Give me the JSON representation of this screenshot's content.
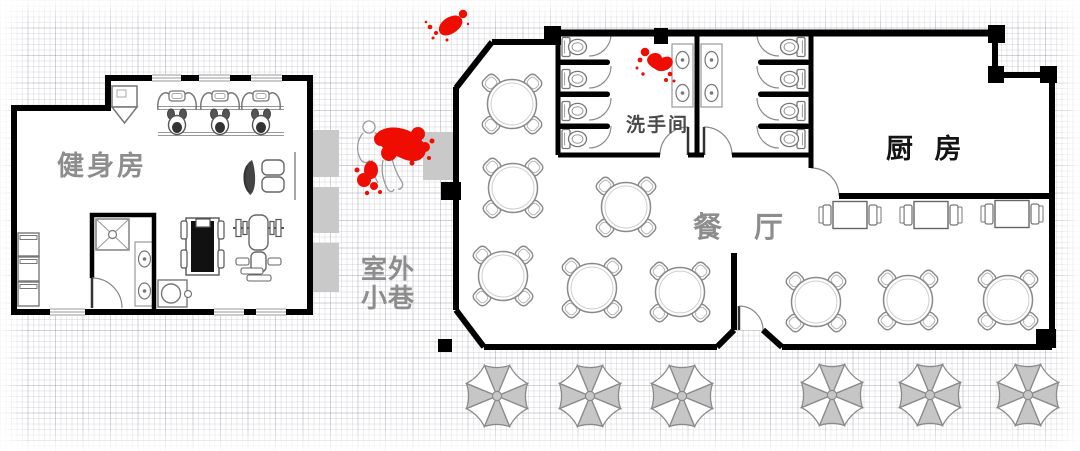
{
  "scene": {
    "type": "floor-plan",
    "description": "Restaurant / gym floor plan with crime-scene blood marks",
    "canvas": {
      "width": 1080,
      "height": 451
    }
  },
  "labels": {
    "gym": "健身房",
    "restroom": "洗手间",
    "kitchen": "厨 房",
    "dining": "餐 厅",
    "alley_line1": "室外",
    "alley_line2": "小巷"
  },
  "colors": {
    "wall": "#000000",
    "blood_red": "#ee0d00",
    "furniture_gray": "#c9c9c9",
    "umbrella_gray": "#c6c6c6",
    "label_gray": "#8d8d8d",
    "kitchen_label": "#141414",
    "outline_gray": "#8a8a8a",
    "grid_line": "#d8d8e0"
  },
  "inventory": {
    "rooms": [
      "健身房",
      "洗手间",
      "厨房",
      "餐厅",
      "室外小巷"
    ],
    "round_tables_with_4_chairs": 9,
    "square_tables_with_2_chairs": 3,
    "outdoor_umbrellas": 6,
    "toilet_stalls": 8,
    "restroom_sinks": 4,
    "gym_cardio_machines": 3,
    "blood_splatters": 3,
    "victim_bodies": 1
  }
}
